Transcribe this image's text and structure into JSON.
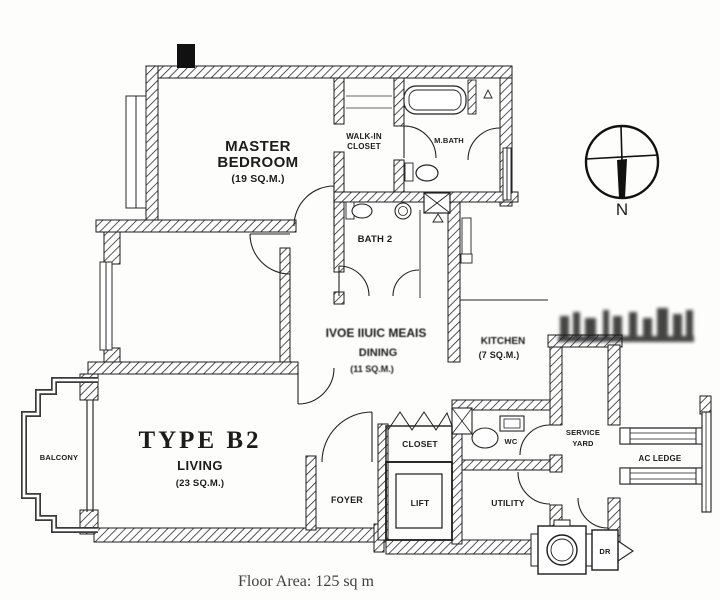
{
  "plan": {
    "unit_type": "TYPE B2",
    "floor_area_note": "Floor Area: 125 sq m",
    "compass_north": "N",
    "rooms": {
      "master_bedroom": {
        "name_line1": "MASTER",
        "name_line2": "BEDROOM",
        "area": "(19 SQ.M.)"
      },
      "walk_in_closet": {
        "name_line1": "WALK-IN",
        "name_line2": "CLOSET"
      },
      "master_bath": {
        "name": "M.BATH"
      },
      "bath_2": {
        "name": "BATH 2"
      },
      "dining": {
        "overprint": "IVOE IIUIC MEAIS",
        "name": "DINING",
        "area": "(11 SQ.M.)"
      },
      "kitchen": {
        "name": "KITCHEN",
        "area": "(7 SQ.M.)"
      },
      "living": {
        "name": "LIVING",
        "area": "(23 SQ.M.)"
      },
      "balcony": {
        "name": "BALCONY"
      },
      "foyer": {
        "name": "FOYER"
      },
      "closet": {
        "name": "CLOSET"
      },
      "lift": {
        "name": "LIFT"
      },
      "wc": {
        "name": "WC"
      },
      "utility": {
        "name": "UTILITY"
      },
      "service_yard": {
        "name_line1": "SERVICE",
        "name_line2": "YARD"
      },
      "ac_ledge": {
        "name": "AC LEDGE"
      },
      "dryer": {
        "name": "DR"
      }
    },
    "colors": {
      "ink": "#1c1c1c",
      "paper": "#ffffff",
      "faded_text": "#3f3f3f"
    }
  }
}
